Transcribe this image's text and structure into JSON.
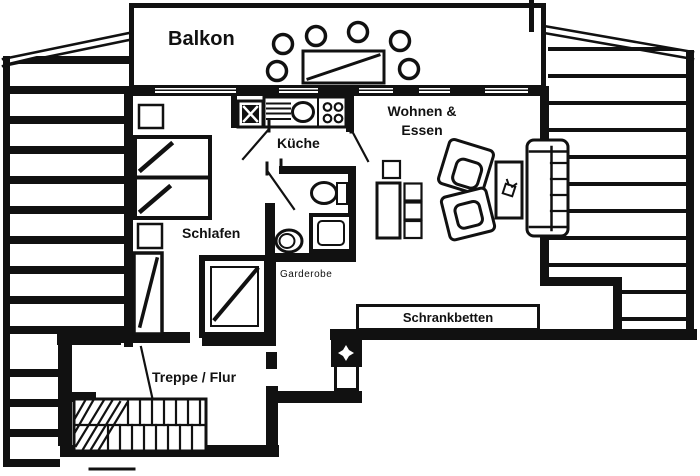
{
  "title": "Apartment floor plan (attic level)",
  "colors": {
    "ink": "#111111",
    "paper": "#ffffff"
  },
  "rooms": {
    "balkon": {
      "label": "Balkon"
    },
    "kueche": {
      "label": "Küche"
    },
    "wohnen": {
      "line1": "Wohnen &",
      "line2": "Essen"
    },
    "schlafen": {
      "label": "Schlafen"
    },
    "garderobe": {
      "label": "Garderobe"
    },
    "schrankbetten": {
      "label": "Schrankbetten"
    },
    "treppe": {
      "label": "Treppe / Flur"
    }
  },
  "symbols": [
    "balcony-table",
    "balcony-chair",
    "double-bed",
    "nightstand",
    "wardrobe",
    "closet",
    "fridge",
    "kitchen-counter",
    "sink",
    "stove",
    "washbasin",
    "shower",
    "wc",
    "dining-table",
    "dining-chair",
    "armchair",
    "coffee-table",
    "plant",
    "sofa",
    "wall-bed-cabinet",
    "chimney",
    "staircase",
    "roof-slope-hatching",
    "door-swing"
  ]
}
